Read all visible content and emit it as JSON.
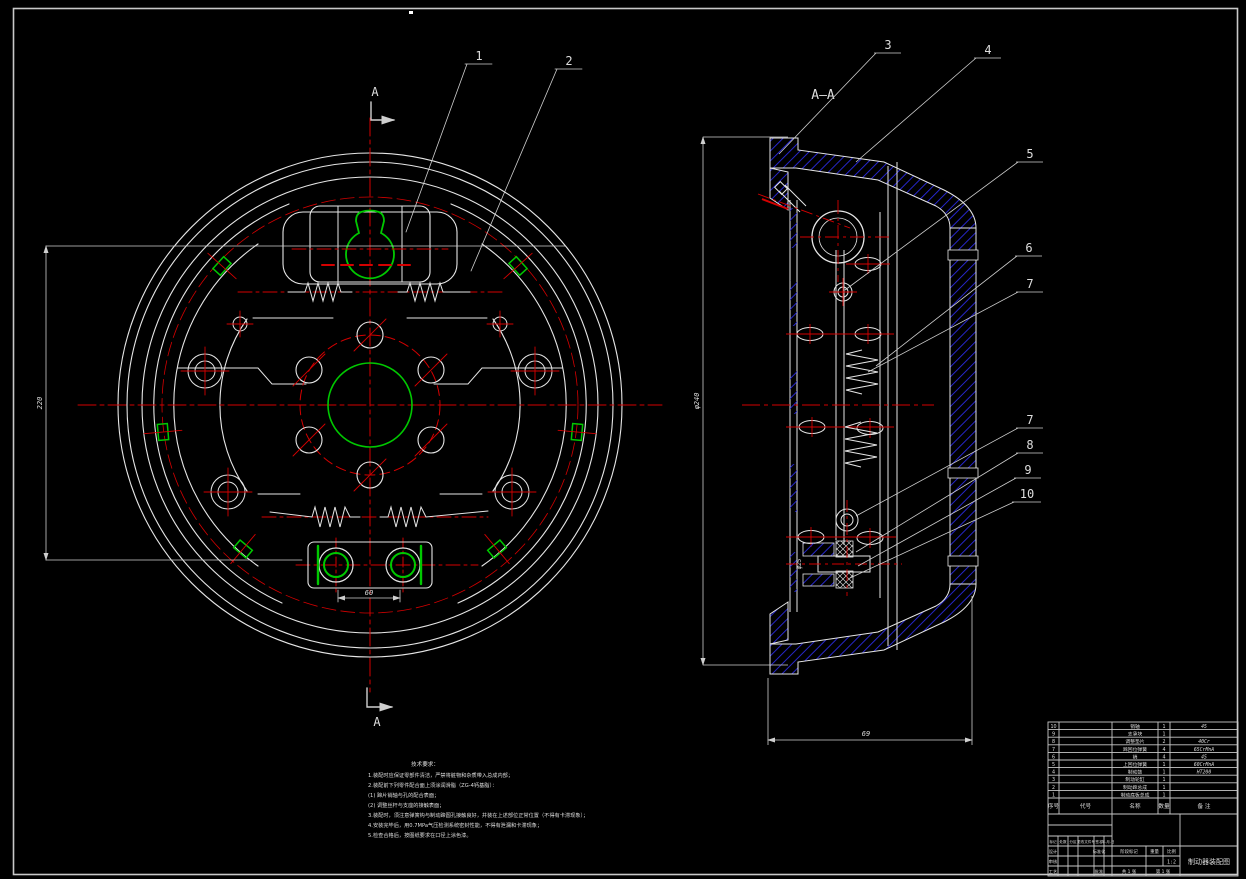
{
  "marks": {
    "cut": "A",
    "section": "A—A"
  },
  "callouts": [
    "1",
    "2",
    "3",
    "4",
    "5",
    "6",
    "7",
    "7",
    "8",
    "9",
    "10"
  ],
  "dimensions": {
    "drum_bore": "220",
    "anchor_pin_span": "60",
    "drum_outer": "φ240",
    "rim_depth": "69",
    "pin_dia": "φ25"
  },
  "notes": {
    "title": "技术要求：",
    "lines": [
      "1.装配时应保证零部件清洁，严禁将脏物和杂质带入总成内部；",
      "2.装配前下列零件配合面上须涂润滑脂（ZG-4钙基脂）：",
      "(1) 蹄片销轴与孔的配合表面；",
      "(2) 调整丝杆与支座的接触表面；",
      "3.装配时，须注意弹簧钩与制动蹄圆孔接触良好，并装在上述部位正常位置（不得有卡滞现象）；",
      "4.安装完毕后，用0.7MPa气压检测系统密封性能，不得有泄漏和卡滞现象；",
      "5.检查合格后，按图纸要求在口径上涂色漆。"
    ]
  },
  "title_block": {
    "bom": {
      "headers": {
        "no": "序号",
        "code": "代号",
        "name": "名称",
        "qty": "数量",
        "remark": "备 注"
      },
      "rows": [
        {
          "no": "10",
          "code": "",
          "name": "销轴",
          "qty": "1",
          "remark": "45"
        },
        {
          "no": "9",
          "code": "",
          "name": "支承块",
          "qty": "1",
          "remark": ""
        },
        {
          "no": "8",
          "code": "",
          "name": "调整垫片",
          "qty": "2",
          "remark": "40Cr"
        },
        {
          "no": "7",
          "code": "",
          "name": "蹄回位弹簧",
          "qty": "4",
          "remark": "65CrMnA"
        },
        {
          "no": "6",
          "code": "",
          "name": "销",
          "qty": "4",
          "remark": "45"
        },
        {
          "no": "5",
          "code": "",
          "name": "上回位弹簧",
          "qty": "1",
          "remark": "60CrMnA"
        },
        {
          "no": "4",
          "code": "",
          "name": "制动鼓",
          "qty": "1",
          "remark": "HT200"
        },
        {
          "no": "3",
          "code": "",
          "name": "制动轮缸",
          "qty": "1",
          "remark": ""
        },
        {
          "no": "2",
          "code": "",
          "name": "制动蹄总成",
          "qty": "1",
          "remark": ""
        },
        {
          "no": "1",
          "code": "",
          "name": "制动底板总成",
          "qty": "1",
          "remark": ""
        }
      ]
    },
    "revision": {
      "mark": "标记",
      "count": "处数",
      "zone": "分区",
      "doc_no": "更改文件号",
      "sign": "签名",
      "date": "年.月.日"
    },
    "roles": {
      "design": "设计",
      "check": "审核",
      "process": "工艺",
      "standard": "标准化",
      "approve": "批准"
    },
    "info": {
      "stage": "阶段标记",
      "weight": "重量",
      "scale": "比例",
      "scale_value": "1:2",
      "sheets": "共 1 张",
      "sheet_no": "第 1 张"
    },
    "title": "制动器装配图"
  }
}
